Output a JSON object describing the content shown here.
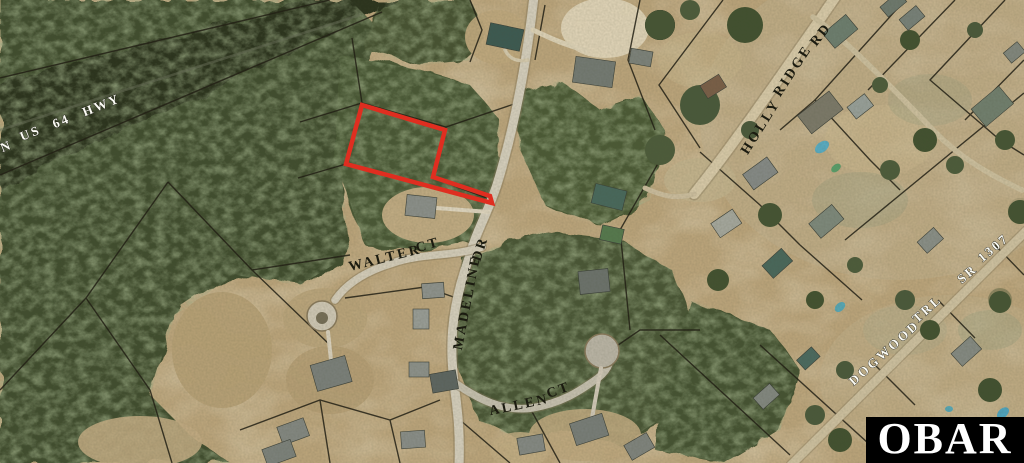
{
  "image": {
    "width": 1024,
    "height": 463,
    "kind": "aerial parcel map with highlighted lot"
  },
  "map": {
    "road_labels": {
      "us64": [
        "N",
        "US",
        "64",
        "HWY"
      ],
      "walter": [
        "WALTER",
        "CT"
      ],
      "madeline": [
        "MADELINE",
        "DR"
      ],
      "allen": [
        "ALLEN",
        "CT"
      ],
      "holly_ridge": [
        "HOLLY",
        "RIDGE",
        "RD"
      ],
      "dogwood": [
        "DOGWOOD",
        "TRL",
        "SR",
        "1307"
      ]
    },
    "highlight": {
      "name": "subject parcel outline",
      "color": "#df2e20"
    },
    "colors": {
      "label_dark": "#1b1b10",
      "label_light": "#fdfdf6",
      "parcel_line": "#1f1c12"
    }
  },
  "watermark": {
    "text": "OBAR",
    "background": "#000000",
    "color": "#ffffff"
  }
}
